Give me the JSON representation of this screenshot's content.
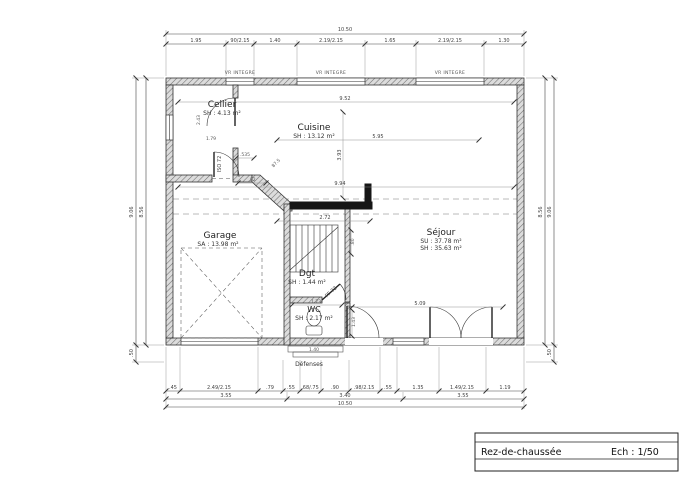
{
  "drawing": {
    "rooms": {
      "cellier": {
        "name": "Cellier",
        "area": "SH : 4.13 m²"
      },
      "cuisine": {
        "name": "Cuisine",
        "area": "SH : 13.12 m²"
      },
      "garage": {
        "name": "Garage",
        "area": "SA : 13.98 m²"
      },
      "sejour": {
        "name": "Séjour",
        "area_su": "SU : 37.78 m²",
        "area_sh": "SH : 35.63 m²"
      },
      "dgt": {
        "name": "Dgt",
        "area": "SH : 1.44 m²"
      },
      "wc": {
        "name": "WC",
        "area": "SH : 2.17 m²"
      }
    },
    "window_labels": [
      "VR INTEGRE",
      "VR INTEGRE",
      "VR INTEGRE"
    ],
    "door_labels": {
      "cellier_garage": "ISO 72",
      "wc": "PF 72"
    },
    "annotations": {
      "defenses": "Défenses"
    },
    "dims": {
      "top_total": "10.50",
      "top_segments": [
        "1.95",
        "90/2.15",
        "1.40",
        "2.19/2.15",
        "1.65",
        "2.19/2.15",
        "1.30"
      ],
      "bottom_row1": [
        ".45",
        "2.49/2.15",
        ".79",
        ".55",
        ".68/.75",
        ".90",
        ".98/2.15",
        ".55",
        "1.35",
        "1.49/2.15",
        "1.19"
      ],
      "bottom_row2": [
        "3.55",
        "3.40",
        "3.55"
      ],
      "bottom_total": "10.50",
      "left": {
        "outer": "9.06",
        "inner": "8.56",
        "bottom": ".50"
      },
      "right": {
        "outer": "9.06",
        "inner": "8.56",
        "bottom": ".50"
      },
      "interior": {
        "width_top": "9.52",
        "width_mid": "9.94",
        "cuisine_width": "5.95",
        "kitchen_wall": "2.72",
        "cuisine_depth": "3.93",
        "sejour_width": "5.09",
        "cellier_door": ".535",
        "garage_top": ".82",
        "angle_wall": "87.5",
        "wc_width": "1.73",
        "wc_depth": "1.43",
        "hall_depth": ".80",
        "entry_width": "1.40",
        "cellier_depth": "2.43",
        "cellier_width": "1.79"
      }
    }
  },
  "title_block": {
    "label": "Rez-de-chaussée",
    "scale": "Ech : 1/50"
  }
}
